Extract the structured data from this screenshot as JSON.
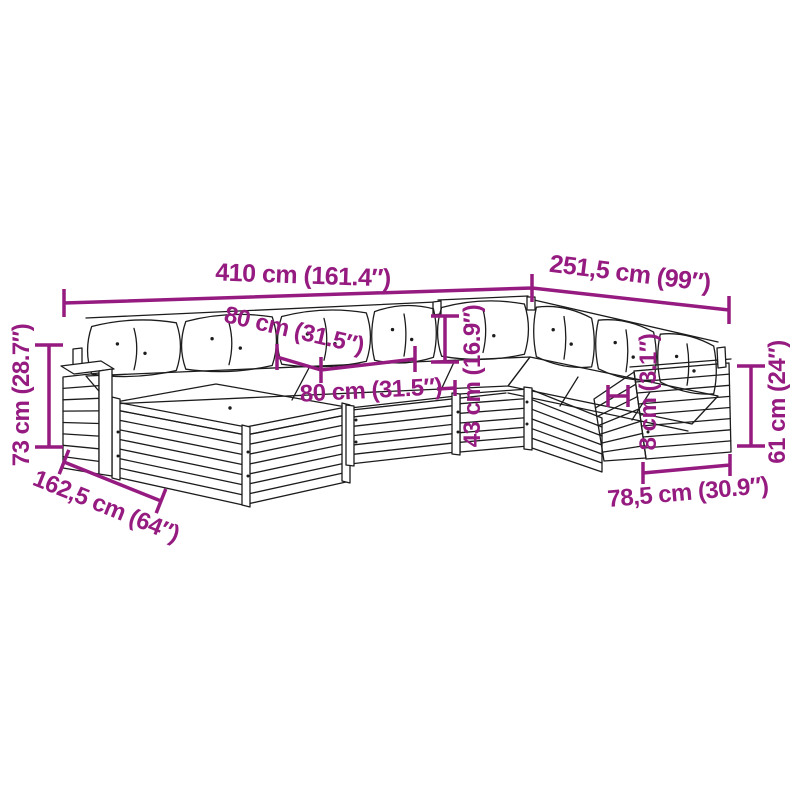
{
  "diagram": {
    "type": "product-dimension-diagram",
    "subject": "garden-pallet-lounge-set-line-drawing",
    "colors": {
      "dimension": "#951b80",
      "line": "#1c1c1c",
      "background": "#ffffff"
    },
    "dimensions": {
      "total_width": {
        "label": "410 cm (161.4″)"
      },
      "right_width": {
        "label": "251,5 cm (99″)"
      },
      "seat_width": {
        "label": "80 cm (31.5″)"
      },
      "seat_depth": {
        "label": "80 cm (31.5″)"
      },
      "backrest_height": {
        "label": "43 cm (16.9″)"
      },
      "cushion_thickness": {
        "label": "8 cm (3.1″)"
      },
      "armrest_height": {
        "label": "61 cm (24″)"
      },
      "module_width": {
        "label": "78,5 cm (30.9″)"
      },
      "total_height": {
        "label": "73 cm (28.7″)"
      },
      "total_depth": {
        "label": "162,5 cm (64″)"
      }
    }
  }
}
